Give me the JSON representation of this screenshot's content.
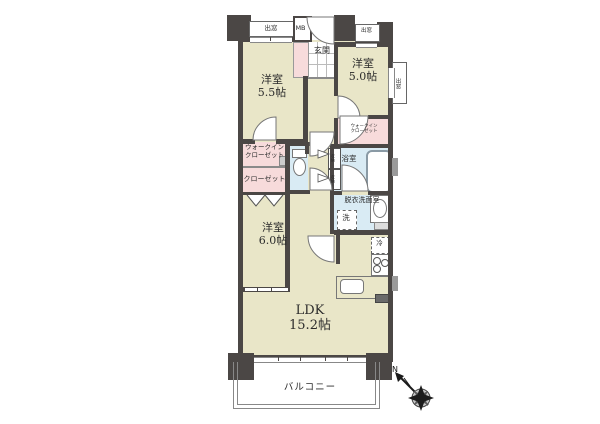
{
  "floorplan": {
    "rooms": {
      "western55": {
        "name": "洋室",
        "size": "5.5帖"
      },
      "western50": {
        "name": "洋室",
        "size": "5.0帖"
      },
      "western60": {
        "name": "洋室",
        "size": "6.0帖"
      },
      "ldk": {
        "name": "LDK",
        "size": "15.2帖"
      },
      "walkin_closet_left": {
        "line1": "ウォークイン",
        "line2": "クローゼット"
      },
      "walkin_closet_right": {
        "line1": "ウォークイン",
        "line2": "クローゼット"
      },
      "closet": {
        "name": "クローゼット"
      },
      "bathroom": {
        "name": "浴室"
      },
      "washroom": {
        "name": "脱衣洗面室"
      },
      "entrance": {
        "name": "玄関"
      },
      "balcony": {
        "name": "バルコニー"
      }
    },
    "labels": {
      "meter_box": "MB",
      "bay_window": "出窓",
      "storage": "収納",
      "washing_machine": "洗",
      "refrigerator": "冷",
      "compass_north": "N"
    },
    "colors": {
      "wall": "#4b4745",
      "room_floor": "#e9e6c8",
      "closet_floor": "#f7dbdb",
      "wet_area_floor": "#d9ebf4",
      "outline": "#888888"
    }
  }
}
